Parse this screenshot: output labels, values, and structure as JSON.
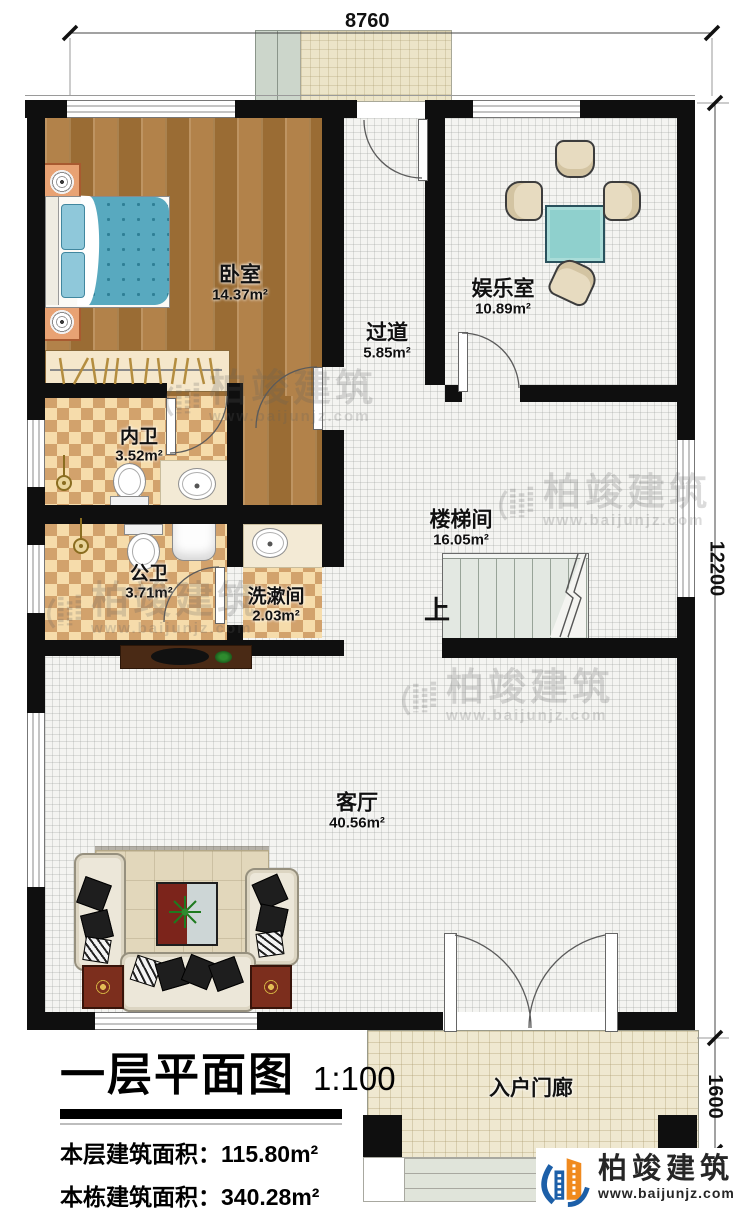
{
  "meta": {
    "drawing_title": "一层平面图",
    "scale": "1:100"
  },
  "dimensions": {
    "top_width": "8760",
    "right_height": "12200",
    "porch_depth": "1600"
  },
  "rooms": {
    "bedroom": {
      "name": "卧室",
      "area": "14.37m²"
    },
    "ensuite_bath": {
      "name": "内卫",
      "area": "3.52m²"
    },
    "public_bath": {
      "name": "公卫",
      "area": "3.71m²"
    },
    "washroom": {
      "name": "洗漱间",
      "area": "2.03m²"
    },
    "hallway": {
      "name": "过道",
      "area": "5.85m²"
    },
    "entertainment": {
      "name": "娱乐室",
      "area": "10.89m²"
    },
    "stairwell": {
      "name": "楼梯间",
      "area": "16.05m²"
    },
    "living_room": {
      "name": "客厅",
      "area": "40.56m²"
    },
    "entry_porch": {
      "name": "入户门廊"
    }
  },
  "stairs": {
    "direction_label": "上"
  },
  "title_block": {
    "title": "一层平面图",
    "scale": "1:100",
    "row1_label": "本层建筑面积：",
    "row1_value": "115.80m²",
    "row2_label": "本栋建筑面积：",
    "row2_value": "340.28m²",
    "row3_label": "占地面积：",
    "row3_value": "123.63m²",
    "row3b_label": "层高：",
    "row3b_value": "3.6m"
  },
  "branding": {
    "watermark_name": "柏竣建筑",
    "watermark_url": "www.baijunjz.com",
    "logo_name": "柏竣建筑",
    "logo_url": "www.baijunjz.com"
  },
  "colors": {
    "wall": "#0f0f0f",
    "wood_floor": "#a9783e",
    "tile_light": "#f6dcab",
    "tile_dark": "#d2a26c",
    "bed_duvet": "#58a9bf",
    "table_teal": "#8fd0cd",
    "logo_blue": "#1c5fa8",
    "logo_orange": "#f08a1e"
  }
}
